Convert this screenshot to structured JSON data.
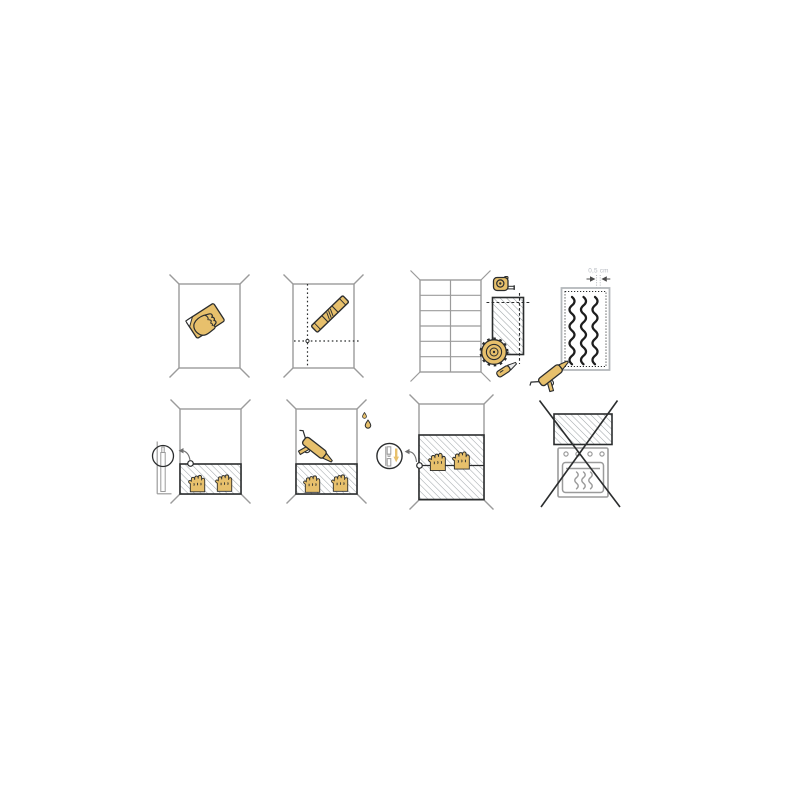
{
  "illustration": {
    "kind": "panel-installation-instructions",
    "background": "#ffffff",
    "colors": {
      "tool_yellow": "#E7C06C",
      "outline_dark": "#2B2D2E",
      "wall_gray": "#9B9B9B",
      "hatch_gray": "#9EA4A8",
      "panel_border_light": "#B4B8BB",
      "label_gray": "#B6BAC0",
      "arrow_gray": "#707070"
    },
    "steps": [
      {
        "index": 1,
        "name": "clean-wall",
        "icons": [
          "wall-outline",
          "hand-with-sponge-icon"
        ]
      },
      {
        "index": 2,
        "name": "mark-guide-lines",
        "icons": [
          "wall-outline",
          "dotted-guide-lines",
          "spirit-level-icon"
        ]
      },
      {
        "index": 3,
        "name": "measure-and-cut-panel",
        "icons": [
          "tiled-wall",
          "tape-measure-icon",
          "cut-panel-piece",
          "dashed-cut-lines",
          "circular-saw-icon",
          "utility-knife-icon"
        ]
      },
      {
        "index": 4,
        "name": "apply-adhesive-beads",
        "dimension_label": "0,5 cm",
        "icons": [
          "panel-back",
          "adhesive-beads",
          "dimension-arrows",
          "caulking-gun-icon"
        ]
      },
      {
        "index": 5,
        "name": "press-first-panel",
        "icons": [
          "wall-outline",
          "bottom-panel",
          "pressing-hands-icon",
          "corner-marker",
          "detail-arrow",
          "magnifier-side-profile"
        ]
      },
      {
        "index": 6,
        "name": "seal-top-edge",
        "icons": [
          "wall-outline",
          "bottom-panel",
          "caulking-gun-icon",
          "water-drops-icon",
          "pressing-hands-icon"
        ]
      },
      {
        "index": 7,
        "name": "slide-second-panel-down",
        "icons": [
          "wall-outline",
          "panel-stack",
          "seam-line",
          "seam-marker",
          "detail-arrow",
          "magnifier-joint-profile",
          "slide-down-arrow",
          "pressing-hands-icon"
        ]
      },
      {
        "index": 8,
        "name": "do-not-install-behind-oven",
        "prohibited": true,
        "icons": [
          "panel-above-oven",
          "oven-icon",
          "heat-waves-icon",
          "prohibition-cross-icon"
        ]
      }
    ]
  }
}
